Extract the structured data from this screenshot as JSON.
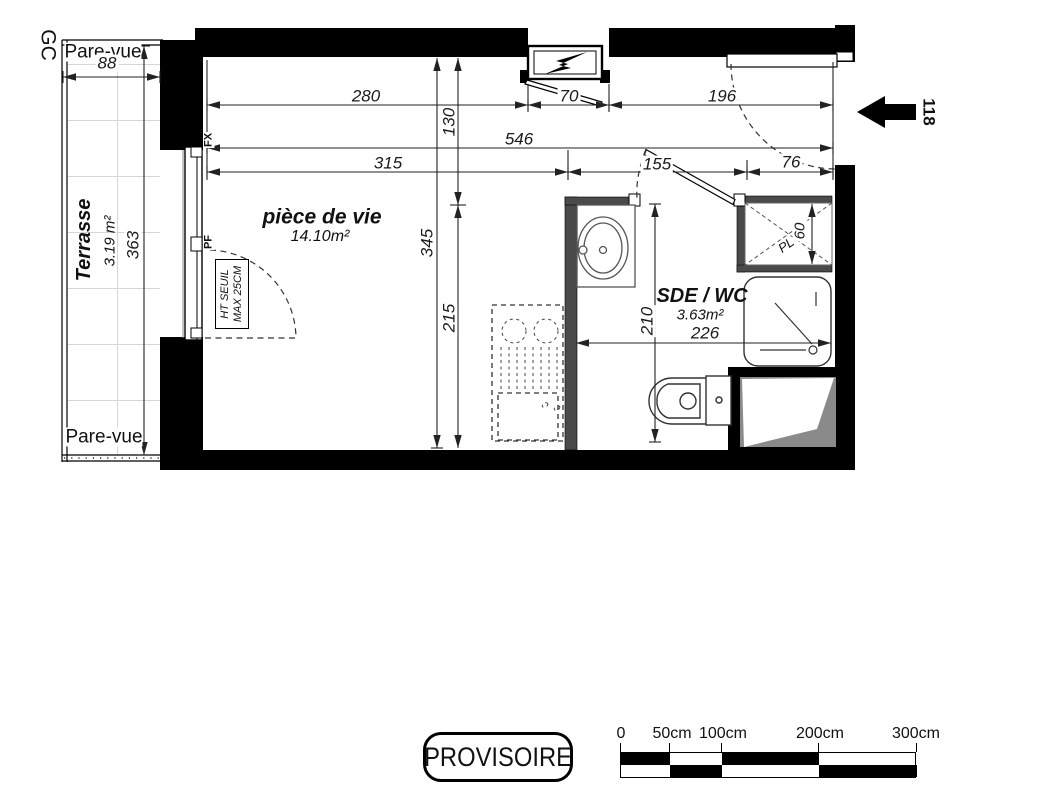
{
  "labels": {
    "gc": "GC",
    "pare_vue_top": "Pare-vue",
    "pare_vue_bottom": "Pare-vue",
    "terrace_name": "Terrasse",
    "terrace_area": "3.19 m²",
    "living_name": "pièce de vie",
    "living_area": "14.10m²",
    "bathroom_name": "SDE / WC",
    "bathroom_area": "3.63m²",
    "closet": "PL",
    "window_fixed": "FX",
    "window_door": "PF",
    "threshold_note_line1": "HT SEUIL",
    "threshold_note_line2": "MAX 25CM",
    "stamp": "PROVISOIRE"
  },
  "dimensions": {
    "terrace_width": "88",
    "terrace_length": "363",
    "top_left": "280",
    "top_panel": "70",
    "top_right": "196",
    "total_width": "546",
    "mid_left": "315",
    "mid_door": "155",
    "mid_closet": "76",
    "entry_depth": "130",
    "room_depth": "345",
    "kitchen_depth": "215",
    "bathroom_depth": "210",
    "bathroom_width": "226",
    "closet_depth": "60",
    "entrance": "118"
  },
  "scale_bar": {
    "labels": [
      "0",
      "50cm",
      "100cm",
      "200cm",
      "300cm"
    ]
  },
  "colors": {
    "wall": "#000000",
    "partition": "#4a4a4a",
    "grid": "#d6d6d6",
    "shade": "#8a8a8a"
  }
}
